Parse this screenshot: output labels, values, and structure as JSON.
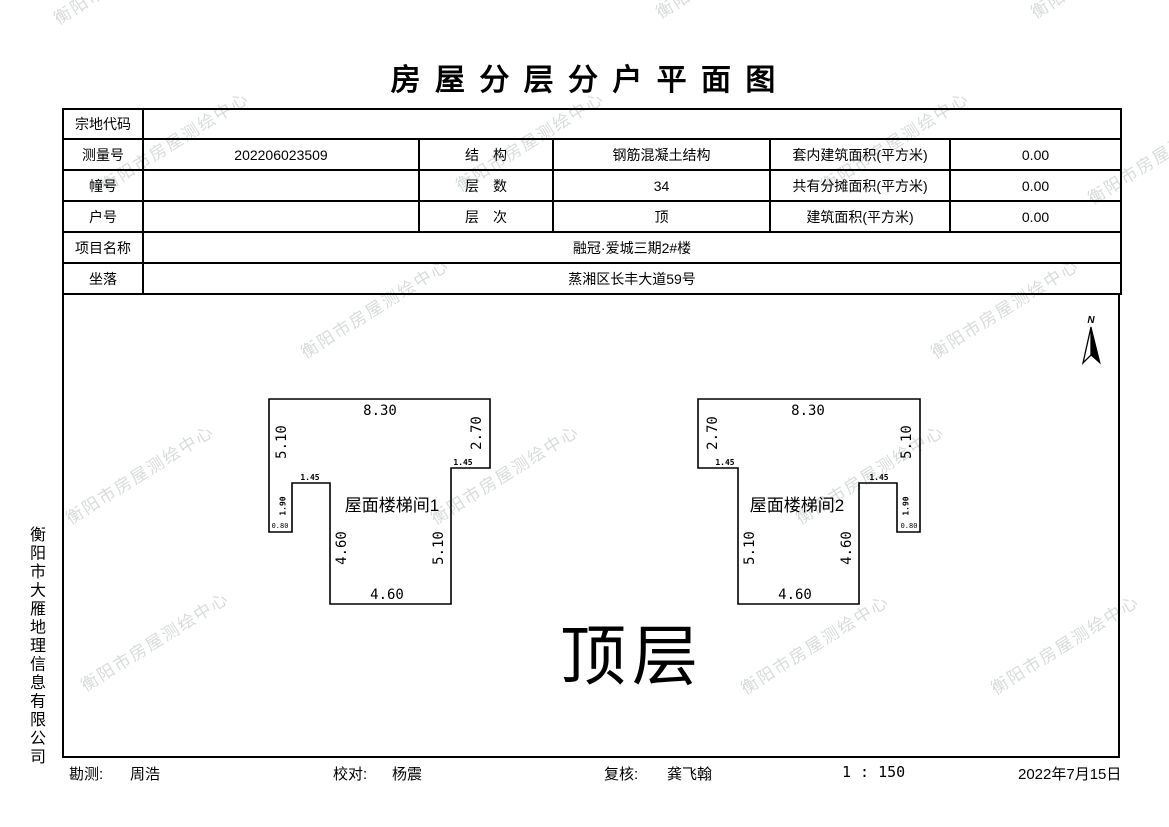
{
  "watermark": {
    "text": "衡阳市房屋测绘中心"
  },
  "title": "房 屋 分 层 分 户 平 面 图",
  "table": {
    "parcel_code": {
      "label": "宗地代码",
      "value": ""
    },
    "survey_no": {
      "label": "测量号",
      "value": "202206023509"
    },
    "structure": {
      "label": "结　构",
      "value": "钢筋混凝土结构"
    },
    "inner_area": {
      "label": "套内建筑面积(平方米)",
      "value": "0.00"
    },
    "building_no": {
      "label": "幢号",
      "value": ""
    },
    "floor_count": {
      "label": "层　数",
      "value": "34"
    },
    "shared_area": {
      "label": "共有分摊面积(平方米)",
      "value": "0.00"
    },
    "unit_no": {
      "label": "户号",
      "value": ""
    },
    "floor_level": {
      "label": "层　次",
      "value": "顶"
    },
    "building_area": {
      "label": "建筑面积(平方米)",
      "value": "0.00"
    },
    "project_name": {
      "label": "项目名称",
      "value": "融冠·爱城三期2#楼"
    },
    "location": {
      "label": "坐落",
      "value": "蒸湘区长丰大道59号"
    }
  },
  "drawing": {
    "north_label": "N",
    "floor_label": "顶层",
    "plans": [
      {
        "name": "屋面楼梯间1",
        "dims": {
          "top": "8.30",
          "side_upper": "2.70",
          "step_outer": "1.45",
          "outer": "5.10",
          "step_inner": "1.45",
          "notch_h": "1.90",
          "notch_w": "0.80",
          "inner_left": "4.60",
          "inner_right": "5.10",
          "bottom": "4.60"
        }
      },
      {
        "name": "屋面楼梯间2",
        "dims": {
          "top": "8.30",
          "side_upper": "2.70",
          "step_outer": "1.45",
          "outer": "5.10",
          "step_inner": "1.45",
          "notch_h": "1.90",
          "notch_w": "0.80",
          "inner_left": "5.10",
          "inner_right": "4.60",
          "bottom": "4.60"
        }
      }
    ]
  },
  "company": "衡阳市大雁地理信息有限公司",
  "footer": {
    "survey_label": "勘测:",
    "survey_name": "周浩",
    "check_label": "校对:",
    "check_name": "杨震",
    "review_label": "复核:",
    "review_name": "龚飞翰",
    "scale": "1 : 150",
    "date": "2022年7月15日"
  }
}
